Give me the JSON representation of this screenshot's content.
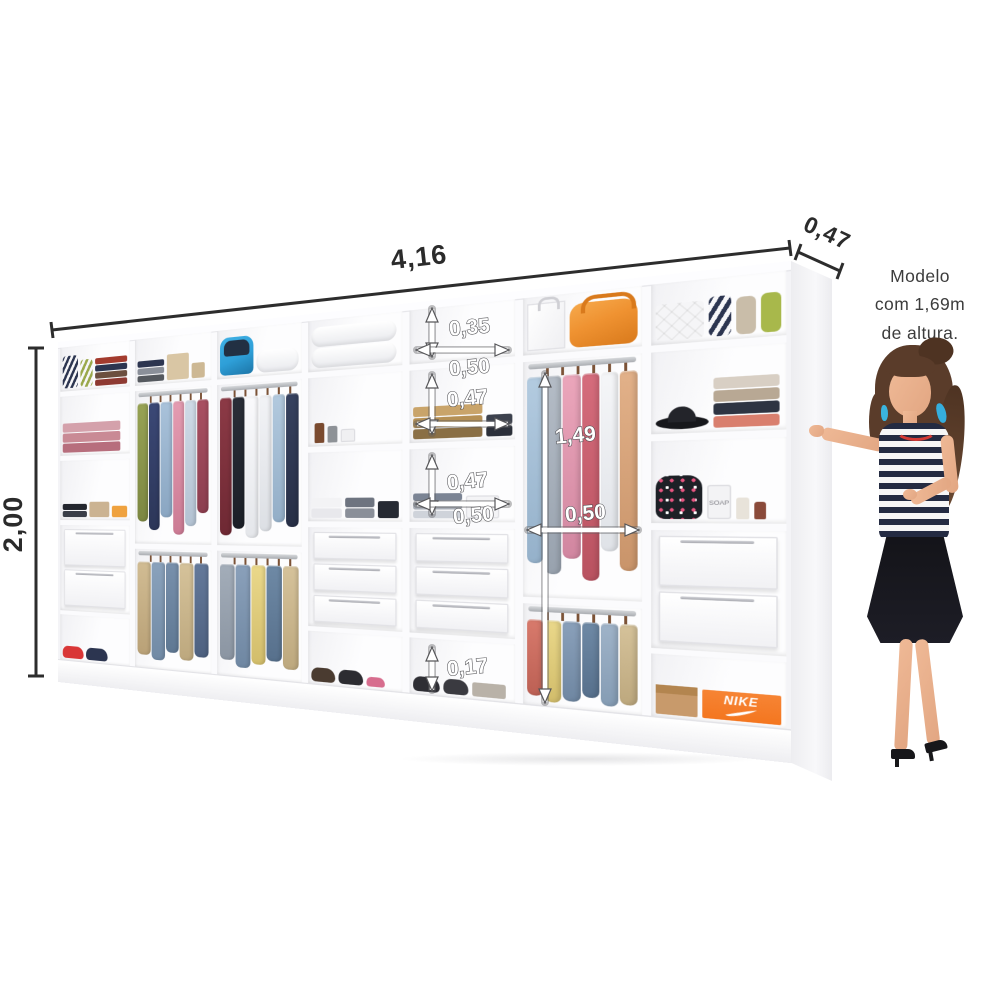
{
  "dimensions": {
    "width": "4,16",
    "depth": "0,47",
    "height": "2,00"
  },
  "internal_dimensions": {
    "top_shelf_height": "0,35",
    "top_shelf_width": "0,50",
    "middle_shelf_height": "0,47",
    "lower_shelf_height": "0,47",
    "lower_shelf_width": "0,50",
    "hanging_section_height": "1,49",
    "hanging_section_width": "0,50",
    "bottom_slot_height": "0,17"
  },
  "model_caption": {
    "line1": "Modelo",
    "line2": "com 1,69m",
    "line3": "de altura."
  },
  "products": {
    "shoebox_brand": "NIKE",
    "soap_bottle_label": "SOAP"
  },
  "colors": {
    "wardrobe_white": "#fbfbfd",
    "dimension_text": "#2b2b2b",
    "internal_label_fill": "#ffffff",
    "nike_orange": "#f4761f",
    "duffel_orange": "#ef9231",
    "backpack_blue": "#2e9fd8",
    "model_top_navy": "#242b42",
    "earring_blue": "#3ab4de"
  }
}
